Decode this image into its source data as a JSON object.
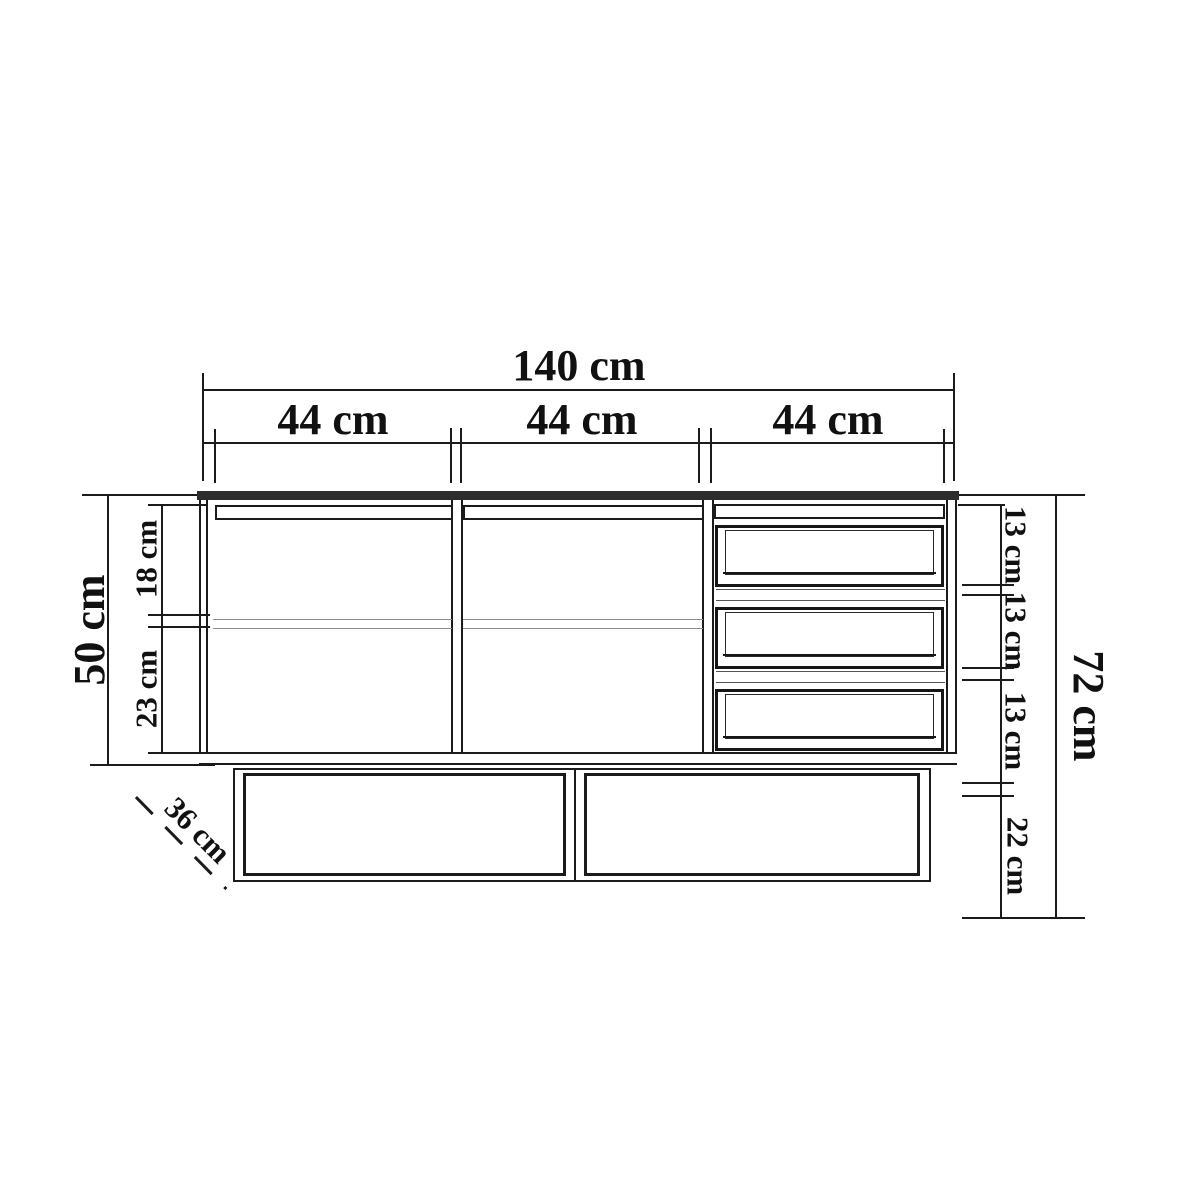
{
  "background": "#ffffff",
  "line_color": "#1b1b1b",
  "unit": "cm",
  "labels": {
    "total_width": "140 cm",
    "sections": [
      "44 cm",
      "44 cm",
      "44 cm"
    ],
    "body_height": "50 cm",
    "inner_top": "18 cm",
    "inner_bottom": "23 cm",
    "drawer_heights": [
      "13 cm",
      "13 cm",
      "13 cm"
    ],
    "base_height": "22 cm",
    "total_height": "72 cm",
    "depth": "36 cm"
  }
}
